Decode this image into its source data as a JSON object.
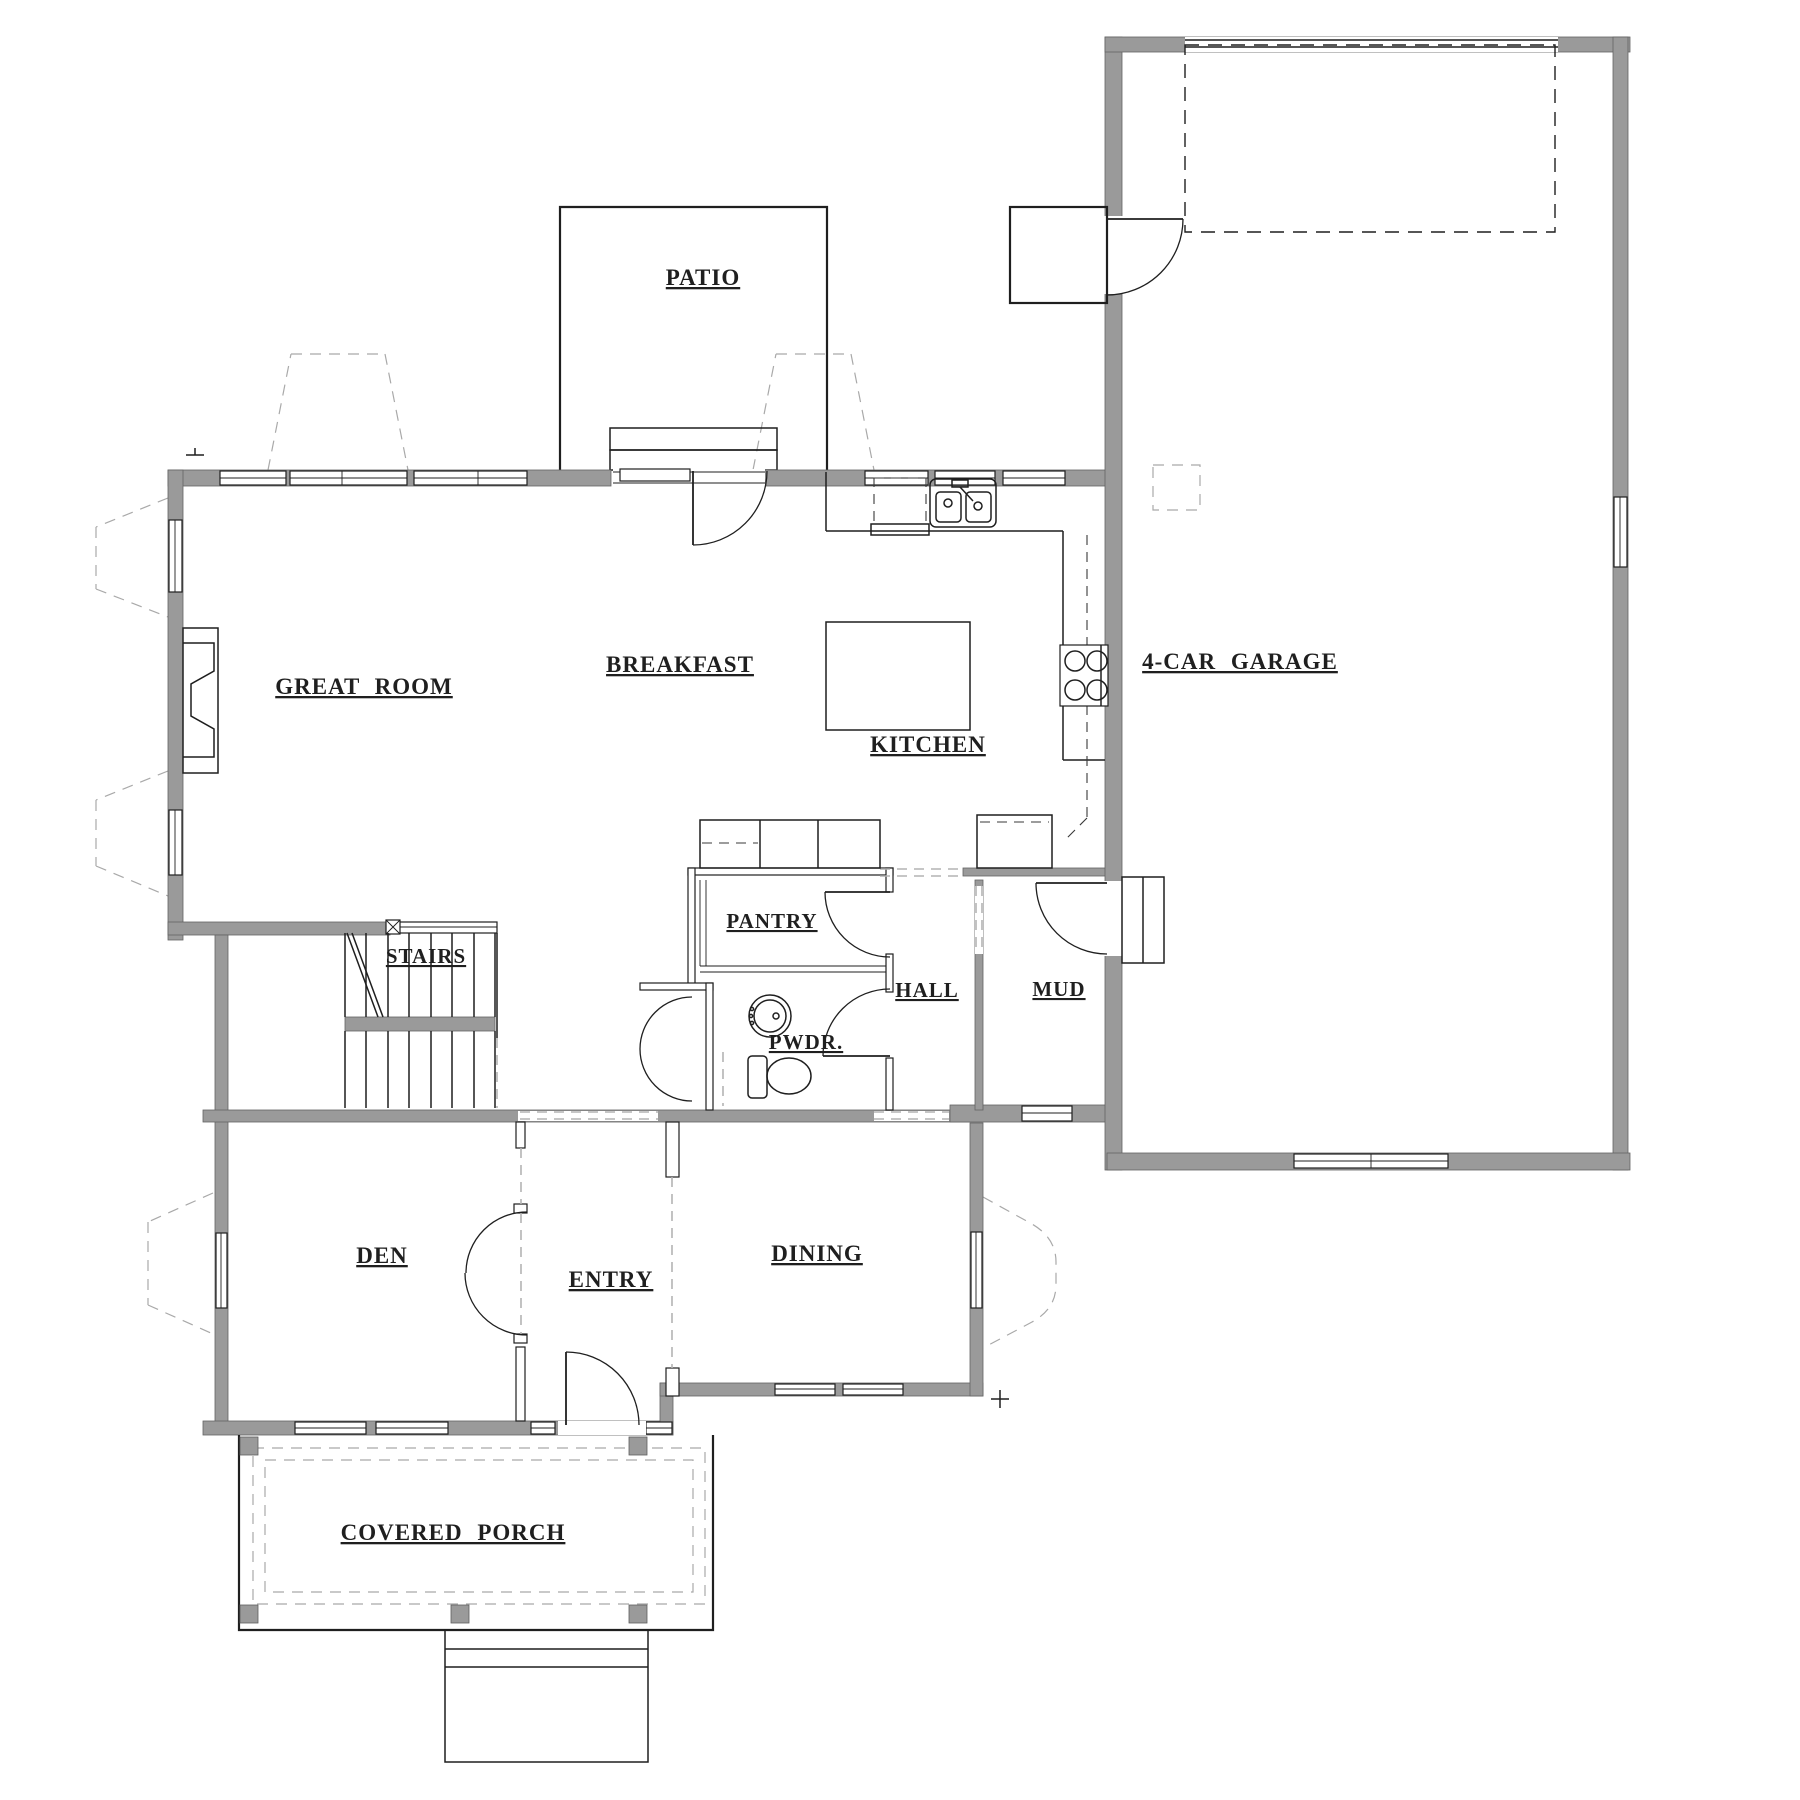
{
  "drawing": {
    "type": "architectural-floor-plan",
    "floor": "main level"
  },
  "colors": {
    "wall": "#9a9a9a",
    "wall_stroke": "#636363",
    "line": "#1f1f1f",
    "dash_gray": "#a9a9a9"
  },
  "rooms": [
    {
      "id": "patio",
      "label": "PATIO"
    },
    {
      "id": "great-room",
      "label": "GREAT ROOM"
    },
    {
      "id": "breakfast",
      "label": "BREAKFAST"
    },
    {
      "id": "kitchen",
      "label": "KITCHEN"
    },
    {
      "id": "garage",
      "label": "4-CAR GARAGE"
    },
    {
      "id": "pantry",
      "label": "PANTRY"
    },
    {
      "id": "stairs",
      "label": "STAIRS"
    },
    {
      "id": "hall",
      "label": "HALL"
    },
    {
      "id": "mud",
      "label": "MUD"
    },
    {
      "id": "pwdr",
      "label": "PWDR."
    },
    {
      "id": "den",
      "label": "DEN"
    },
    {
      "id": "entry",
      "label": "ENTRY"
    },
    {
      "id": "dining",
      "label": "DINING"
    },
    {
      "id": "covered-porch",
      "label": "COVERED PORCH"
    }
  ]
}
